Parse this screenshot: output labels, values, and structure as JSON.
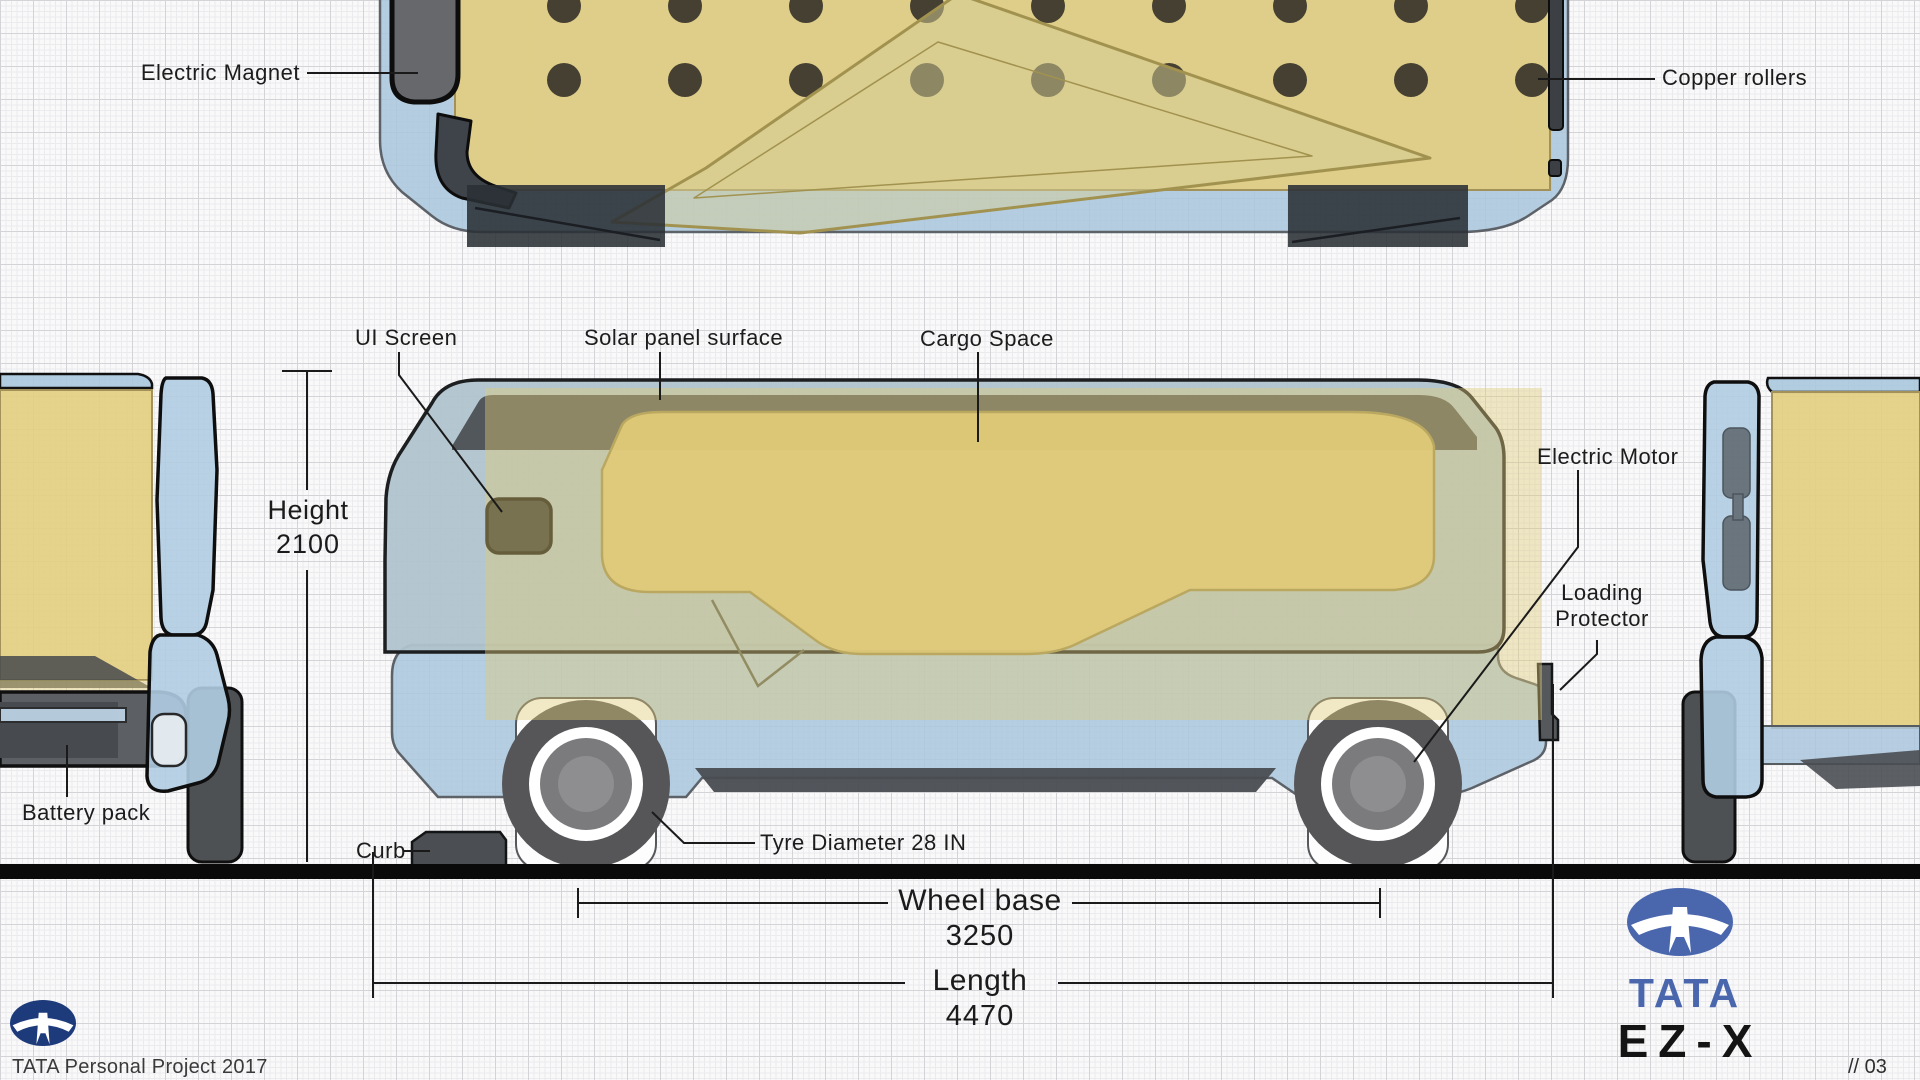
{
  "drawing": {
    "callouts": {
      "electric_magnet": "Electric Magnet",
      "copper_rollers": "Copper rollers",
      "ui_screen": "UI Screen",
      "solar_panel_surface": "Solar panel surface",
      "cargo_space": "Cargo Space",
      "electric_motor": "Electric Motor",
      "loading_protector": "Loading Protector",
      "battery_pack": "Battery pack",
      "curb": "Curb",
      "tyre_diameter": "Tyre Diameter 28 IN"
    },
    "dimensions": {
      "height": {
        "label": "Height",
        "value": "2100"
      },
      "wheel_base": {
        "label": "Wheel base",
        "value": "3250"
      },
      "length": {
        "label": "Length",
        "value": "4470"
      }
    }
  },
  "footer": {
    "credit": "TATA Personal Project 2017",
    "page": "// 03",
    "brand_wordmark": "TATA",
    "model_wordmark": "EZ-X"
  },
  "colors": {
    "body_blue": "#aac4da",
    "cargo_yellow": "#e2cd82",
    "frame_dark": "#4e5356",
    "outline_black": "#121314",
    "tan_stroke": "#a2925a",
    "tata_blue": "#4a67ae",
    "tata_navy": "#1d3a7a",
    "ground_black": "#0a0a0a"
  }
}
